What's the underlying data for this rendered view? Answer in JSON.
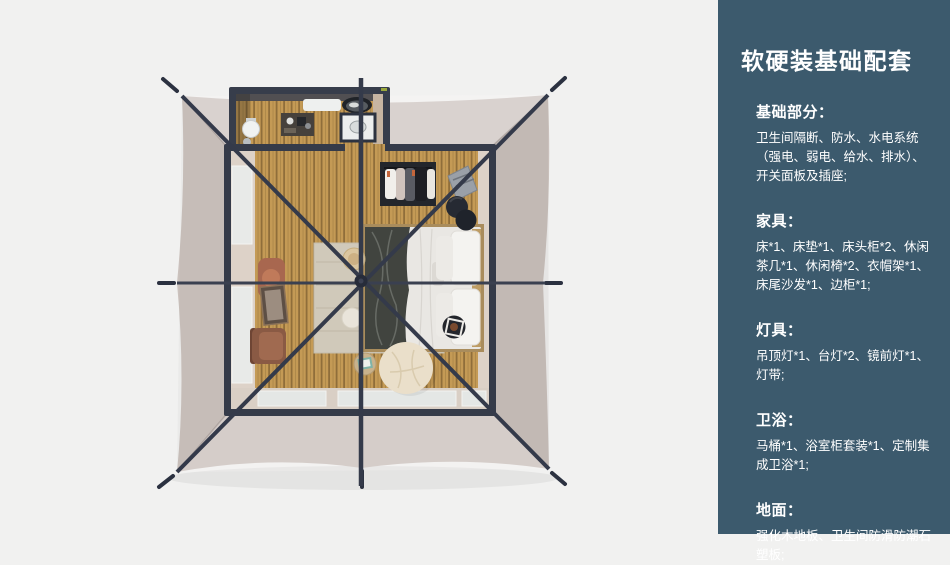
{
  "colors": {
    "background": "#f1f1f0",
    "sidebar-bg": "#3c5a6d",
    "sidebar-text": "#ffffff",
    "tent-canvas": "#cbc2bd",
    "frame-dark": "#353b49",
    "wood-floor": "#c49a55"
  },
  "sidebar": {
    "title": "软硬装基础配套",
    "sections": [
      {
        "heading": "基础部分：",
        "body": "卫生间隔断、防水、水电系统\n（强电、弱电、给水、排水）、\n开关面板及插座;"
      },
      {
        "heading": "家具：",
        "body": "床*1、床垫*1、床头柜*2、休闲\n茶几*1、休闲椅*2、衣帽架*1、\n床尾沙发*1、边柜*1;"
      },
      {
        "heading": "灯具：",
        "body": "吊顶灯*1、台灯*2、镜前灯*1、\n灯带;"
      },
      {
        "heading": "卫浴：",
        "body": "马桶*1、浴室柜套装*1、定制集\n成卫浴*1;"
      },
      {
        "heading": "地面：",
        "body": "强化木地板、卫生间防滑防潮石\n塑板;"
      }
    ]
  }
}
